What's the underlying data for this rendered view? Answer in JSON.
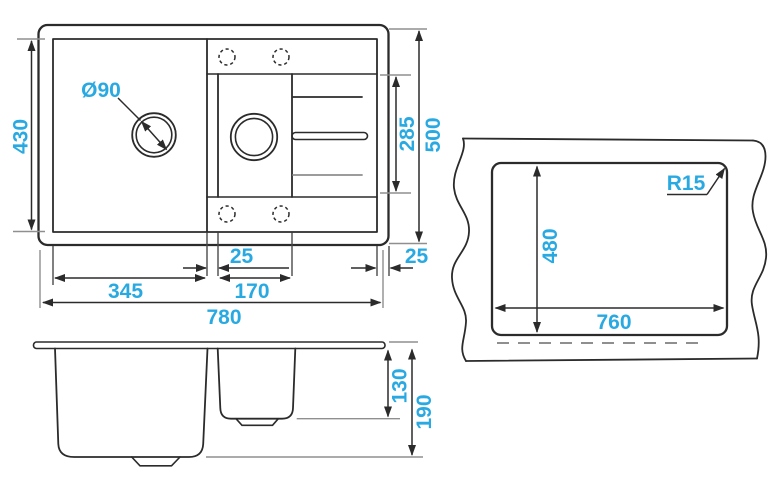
{
  "colors": {
    "dimension_text": "#29a9e2",
    "drawing_lines": "#2b2b2b",
    "extension_lines": "#8f8f8f",
    "background": "#ffffff"
  },
  "top_view": {
    "drain_diameter": "Ø90",
    "basin_height": "430",
    "right_section_height": "285",
    "overall_height": "500",
    "left_gap": "25",
    "left_bowl_width": "345",
    "small_bowl_width": "170",
    "right_gap": "25",
    "overall_width": "780"
  },
  "cutout_view": {
    "corner_radius": "R15",
    "cutout_height": "480",
    "cutout_width": "760"
  },
  "side_view": {
    "small_bowl_depth": "130",
    "overall_depth": "190"
  }
}
